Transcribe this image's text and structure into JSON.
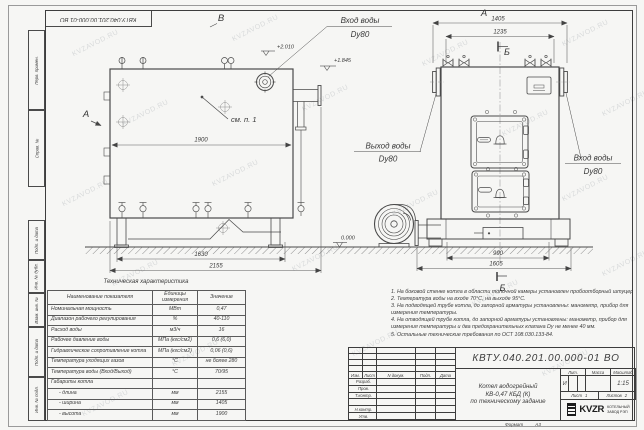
{
  "watermark": {
    "text": "KVZAVOD.RU"
  },
  "frame": {
    "top_stamp": "КВТУ.040.201.00.000-01 ВО",
    "side_fields_top": [
      "Перв. примен.",
      "Справ. №"
    ],
    "side_fields_bottom": [
      "Подп. и дата",
      "Инв. № дубл.",
      "Взам. инв. №",
      "Подп. и дата",
      "Инв. № подл."
    ],
    "format_label": "Формат",
    "format_value": "А3"
  },
  "drawing": {
    "view_marks": {
      "top": "В",
      "side": "А",
      "front": "А",
      "section_top": "Б",
      "section_bottom": "Б"
    },
    "callout_note": "см. п. 1",
    "elevations": {
      "side_top": "+2.010",
      "side_outlet": "+1.845",
      "ground": "0.000"
    },
    "dims": {
      "side_width": "1900",
      "side_base": "1630",
      "side_total": "2155",
      "front_overall": "1405",
      "front_inner": "1235",
      "front_base_inner": "990",
      "front_base_outer": "1605"
    },
    "pipe_labels": {
      "inlet_top_1": "Вход воды",
      "inlet_top_2": "Dy80",
      "outlet_1": "Выход воды",
      "outlet_2": "Dy80",
      "inlet_right_1": "Вход воды",
      "inlet_right_2": "Dy80"
    }
  },
  "spec_table": {
    "title": "Техническая характеристика",
    "col_name": "Наименование показателя",
    "col_units_line1": "Единицы",
    "col_units_line2": "измерения",
    "col_value": "Значение",
    "rows": [
      {
        "name": "Номинальная мощность",
        "units": "МВт",
        "value": "0,47"
      },
      {
        "name": "Диапазон рабочего регулирования",
        "units": "%",
        "value": "40-110"
      },
      {
        "name": "Расход воды",
        "units": "м3/ч",
        "value": "16"
      },
      {
        "name": "Рабочее давление воды",
        "units": "МПа (кгс/см2)",
        "value": "0,6 (6,0)"
      },
      {
        "name": "Гидравлическое сопротивление котла",
        "units": "МПа (кгс/см2)",
        "value": "0,06 (0,6)"
      },
      {
        "name": "Температура уходящих газов",
        "units": "°С",
        "value": "не более 280"
      },
      {
        "name": "Температура воды (Вход/Выход)",
        "units": "°С",
        "value": "70/95"
      },
      {
        "name": "Габариты котла",
        "units": "",
        "value": ""
      },
      {
        "name": "- длина",
        "units": "мм",
        "value": "2155"
      },
      {
        "name": "- ширина",
        "units": "мм",
        "value": "1405"
      },
      {
        "name": "- высота",
        "units": "мм",
        "value": "1900"
      }
    ]
  },
  "notes": [
    "1.  На боковой стенке котла в области топочной камеры установлен пробоотборный штуцер",
    "2.  Температура воды на входе  70°С, на выходе  95°С.",
    "3.  На подводящей трубе котла, до запорной арматуры установлены: манометр, прибор для измерения температуры.",
    "4.  На отводящей трубе котла, до запорной арматуры установлены: манометр, прибор для измерения температуры и два предохранительных клапана  Dу не менее  40 мм.",
    "5.  Остальные технические требования по ОСТ 108.030.133-84."
  ],
  "title_block": {
    "doc_number": "КВТУ.040.201.00.000-01 ВО",
    "product_line1": "Котел водогрейный",
    "product_line2": "КВ-0,47 КБД (К)",
    "product_line3": "по техническому задание",
    "col_izm": "Изм.",
    "col_list": "Лист",
    "col_doc": "N докум.",
    "col_podp": "Подп.",
    "col_data": "Дата",
    "sign_rows": [
      "Разраб.",
      "Пров.",
      "Т.контр.",
      "",
      "Н.контр.",
      "Утв."
    ],
    "lit_label": "Лит.",
    "mass_label": "Масса",
    "scale_label": "Масштаб",
    "lit_value": "И",
    "mass_value": "",
    "scale_value": "1:15",
    "sheet_label": "Лист",
    "sheet_value": "1",
    "sheets_label": "Листов",
    "sheets_value": "2",
    "company_logo": "KVZR",
    "company_line1": "КОТЕЛЬНЫЙ",
    "company_line2": "ЗАВОД РЭП"
  }
}
